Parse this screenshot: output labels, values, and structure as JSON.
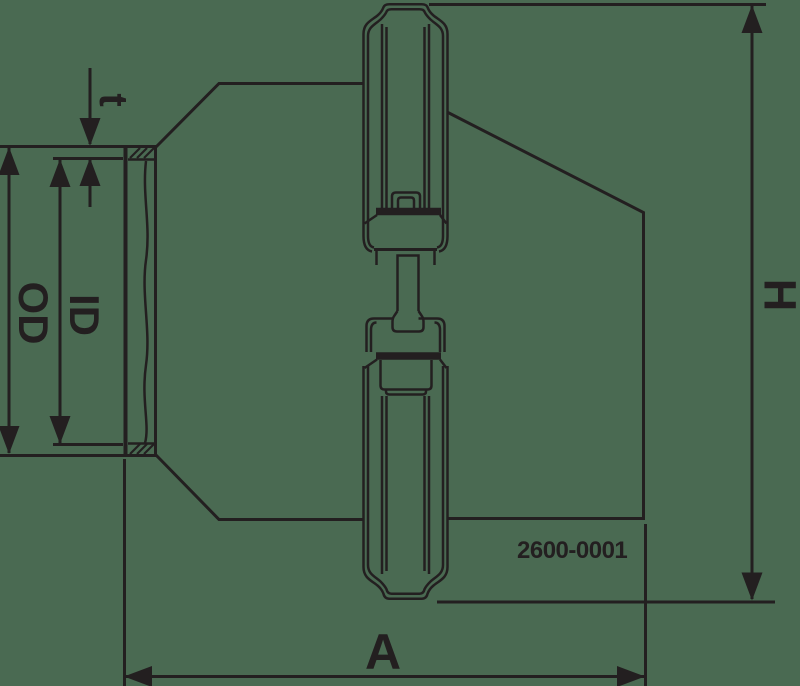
{
  "drawing": {
    "part_number": "2600-0001",
    "dimensions": {
      "wall_thickness": "t",
      "inner_diameter": "ID",
      "outer_diameter": "OD",
      "overall_height": "H",
      "overall_length": "A"
    }
  },
  "colors": {
    "background": "#4a6a52",
    "ink": "#231f20"
  }
}
